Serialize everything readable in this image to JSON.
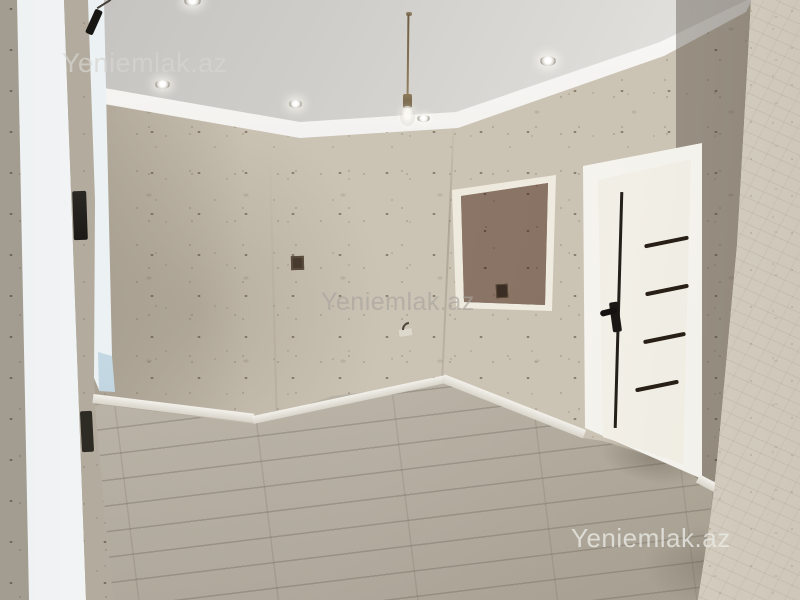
{
  "watermarks": {
    "top_left": "Yeniemlak.az",
    "center": "Yeniemlak.az",
    "bottom_right": "Yeniemlak.az"
  },
  "scene": {
    "type": "real-estate interior photo",
    "description": "Empty newly renovated room: speckled beige liquid-wallpaper walls, white ceiling with crown molding and recessed spotlights, bare pendant bulb on a cord, white interior door with four horizontal and one vertical black glass strips and black handle, brown fiberboard panel framed in white molding on the right wall, bright window light bands on the left, light grey laminate plank flooring, white baseboards, near wall column on the far right",
    "counts": {
      "recessed_spotlights": 5,
      "pendant_bulbs": 1,
      "door_horizontal_strips": 4,
      "door_vertical_strips": 1
    }
  },
  "colors": {
    "wallpaper": "#cbc3b4",
    "wallpaper_speckle": "#5e4a38",
    "ceiling": "#d8d6d2",
    "molding": "#f3f2ee",
    "floor": "#bfb8ac",
    "door": "#efece3",
    "door_strips": "#281f16",
    "panel_board": "#8d7768",
    "window_light": "#fbfcfd",
    "window_sill_tint": "#b4cddc",
    "watermark": "#e8e7e3"
  }
}
